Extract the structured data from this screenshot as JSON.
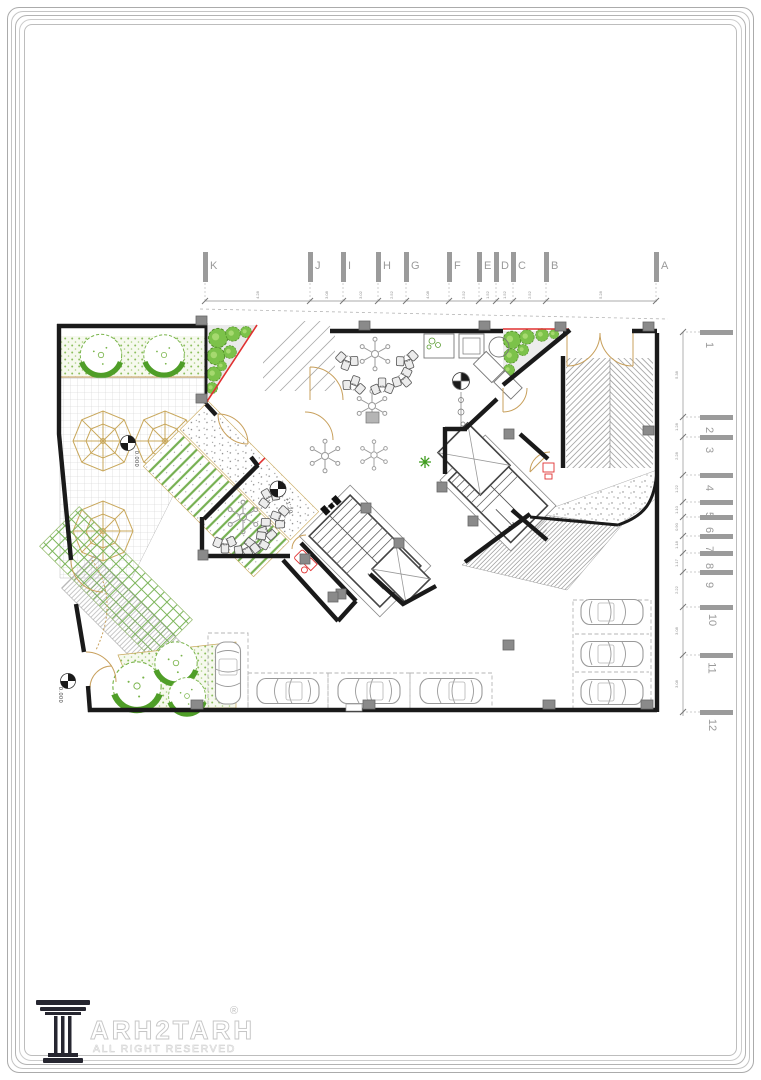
{
  "page": {
    "title": "architectural ground floor plan sheet"
  },
  "grid": {
    "columns": [
      {
        "label": "K",
        "x": 205
      },
      {
        "label": "J",
        "x": 310
      },
      {
        "label": "I",
        "x": 343
      },
      {
        "label": "H",
        "x": 378
      },
      {
        "label": "G",
        "x": 406
      },
      {
        "label": "F",
        "x": 449
      },
      {
        "label": "E",
        "x": 479
      },
      {
        "label": "D",
        "x": 496
      },
      {
        "label": "C",
        "x": 513
      },
      {
        "label": "B",
        "x": 546
      },
      {
        "label": "A",
        "x": 656
      }
    ],
    "rows": [
      {
        "label": "1",
        "y": 332
      },
      {
        "label": "2",
        "y": 417
      },
      {
        "label": "3",
        "y": 437
      },
      {
        "label": "4",
        "y": 475
      },
      {
        "label": "5",
        "y": 502
      },
      {
        "label": "6",
        "y": 517
      },
      {
        "label": "7",
        "y": 536
      },
      {
        "label": "8",
        "y": 553
      },
      {
        "label": "9",
        "y": 572
      },
      {
        "label": "10",
        "y": 607
      },
      {
        "label": "11",
        "y": 655
      },
      {
        "label": "12",
        "y": 712
      }
    ],
    "top_dims": [
      {
        "label": "4.28",
        "x": 258
      },
      {
        "label": "3.08",
        "x": 327
      },
      {
        "label": "3.02",
        "x": 361
      },
      {
        "label": "2.52",
        "x": 392
      },
      {
        "label": "4.08",
        "x": 428
      },
      {
        "label": "2.52",
        "x": 464
      },
      {
        "label": "1.52",
        "x": 488
      },
      {
        "label": "1.52",
        "x": 505
      },
      {
        "label": "2.52",
        "x": 530
      },
      {
        "label": "5.28",
        "x": 601
      }
    ],
    "right_dims": [
      {
        "label": "5.38",
        "y": 375
      },
      {
        "label": "1.28",
        "y": 427
      },
      {
        "label": "2.28",
        "y": 456
      },
      {
        "label": "1.22",
        "y": 489
      },
      {
        "label": "1.10",
        "y": 510
      },
      {
        "label": "0.90",
        "y": 527
      },
      {
        "label": "1.18",
        "y": 545
      },
      {
        "label": "1.17",
        "y": 563
      },
      {
        "label": "2.22",
        "y": 590
      },
      {
        "label": "3.08",
        "y": 631
      },
      {
        "label": "3.08",
        "y": 684
      }
    ]
  },
  "plan": {
    "elevation_markers": [
      {
        "text": "0.000",
        "x": 128,
        "y": 456,
        "rot": 90
      },
      {
        "text": "0.000",
        "x": 52,
        "y": 692,
        "rot": 90
      },
      {
        "text": "+1.20",
        "x": 280,
        "y": 503,
        "rot": 75
      }
    ],
    "colors": {
      "wall": "#1a1a1a",
      "red_accent": "#e03131",
      "tan": "#c8a05c",
      "column_gray": "#8a8a8a",
      "green_tree": "#55a12c",
      "green_light": "#8cc63f",
      "hatch_gray": "#8e8e8e"
    }
  },
  "footer": {
    "brand_text": "ARH2TARH",
    "registered_mark": "®",
    "tagline": "ALL RIGHT RESERVED"
  }
}
